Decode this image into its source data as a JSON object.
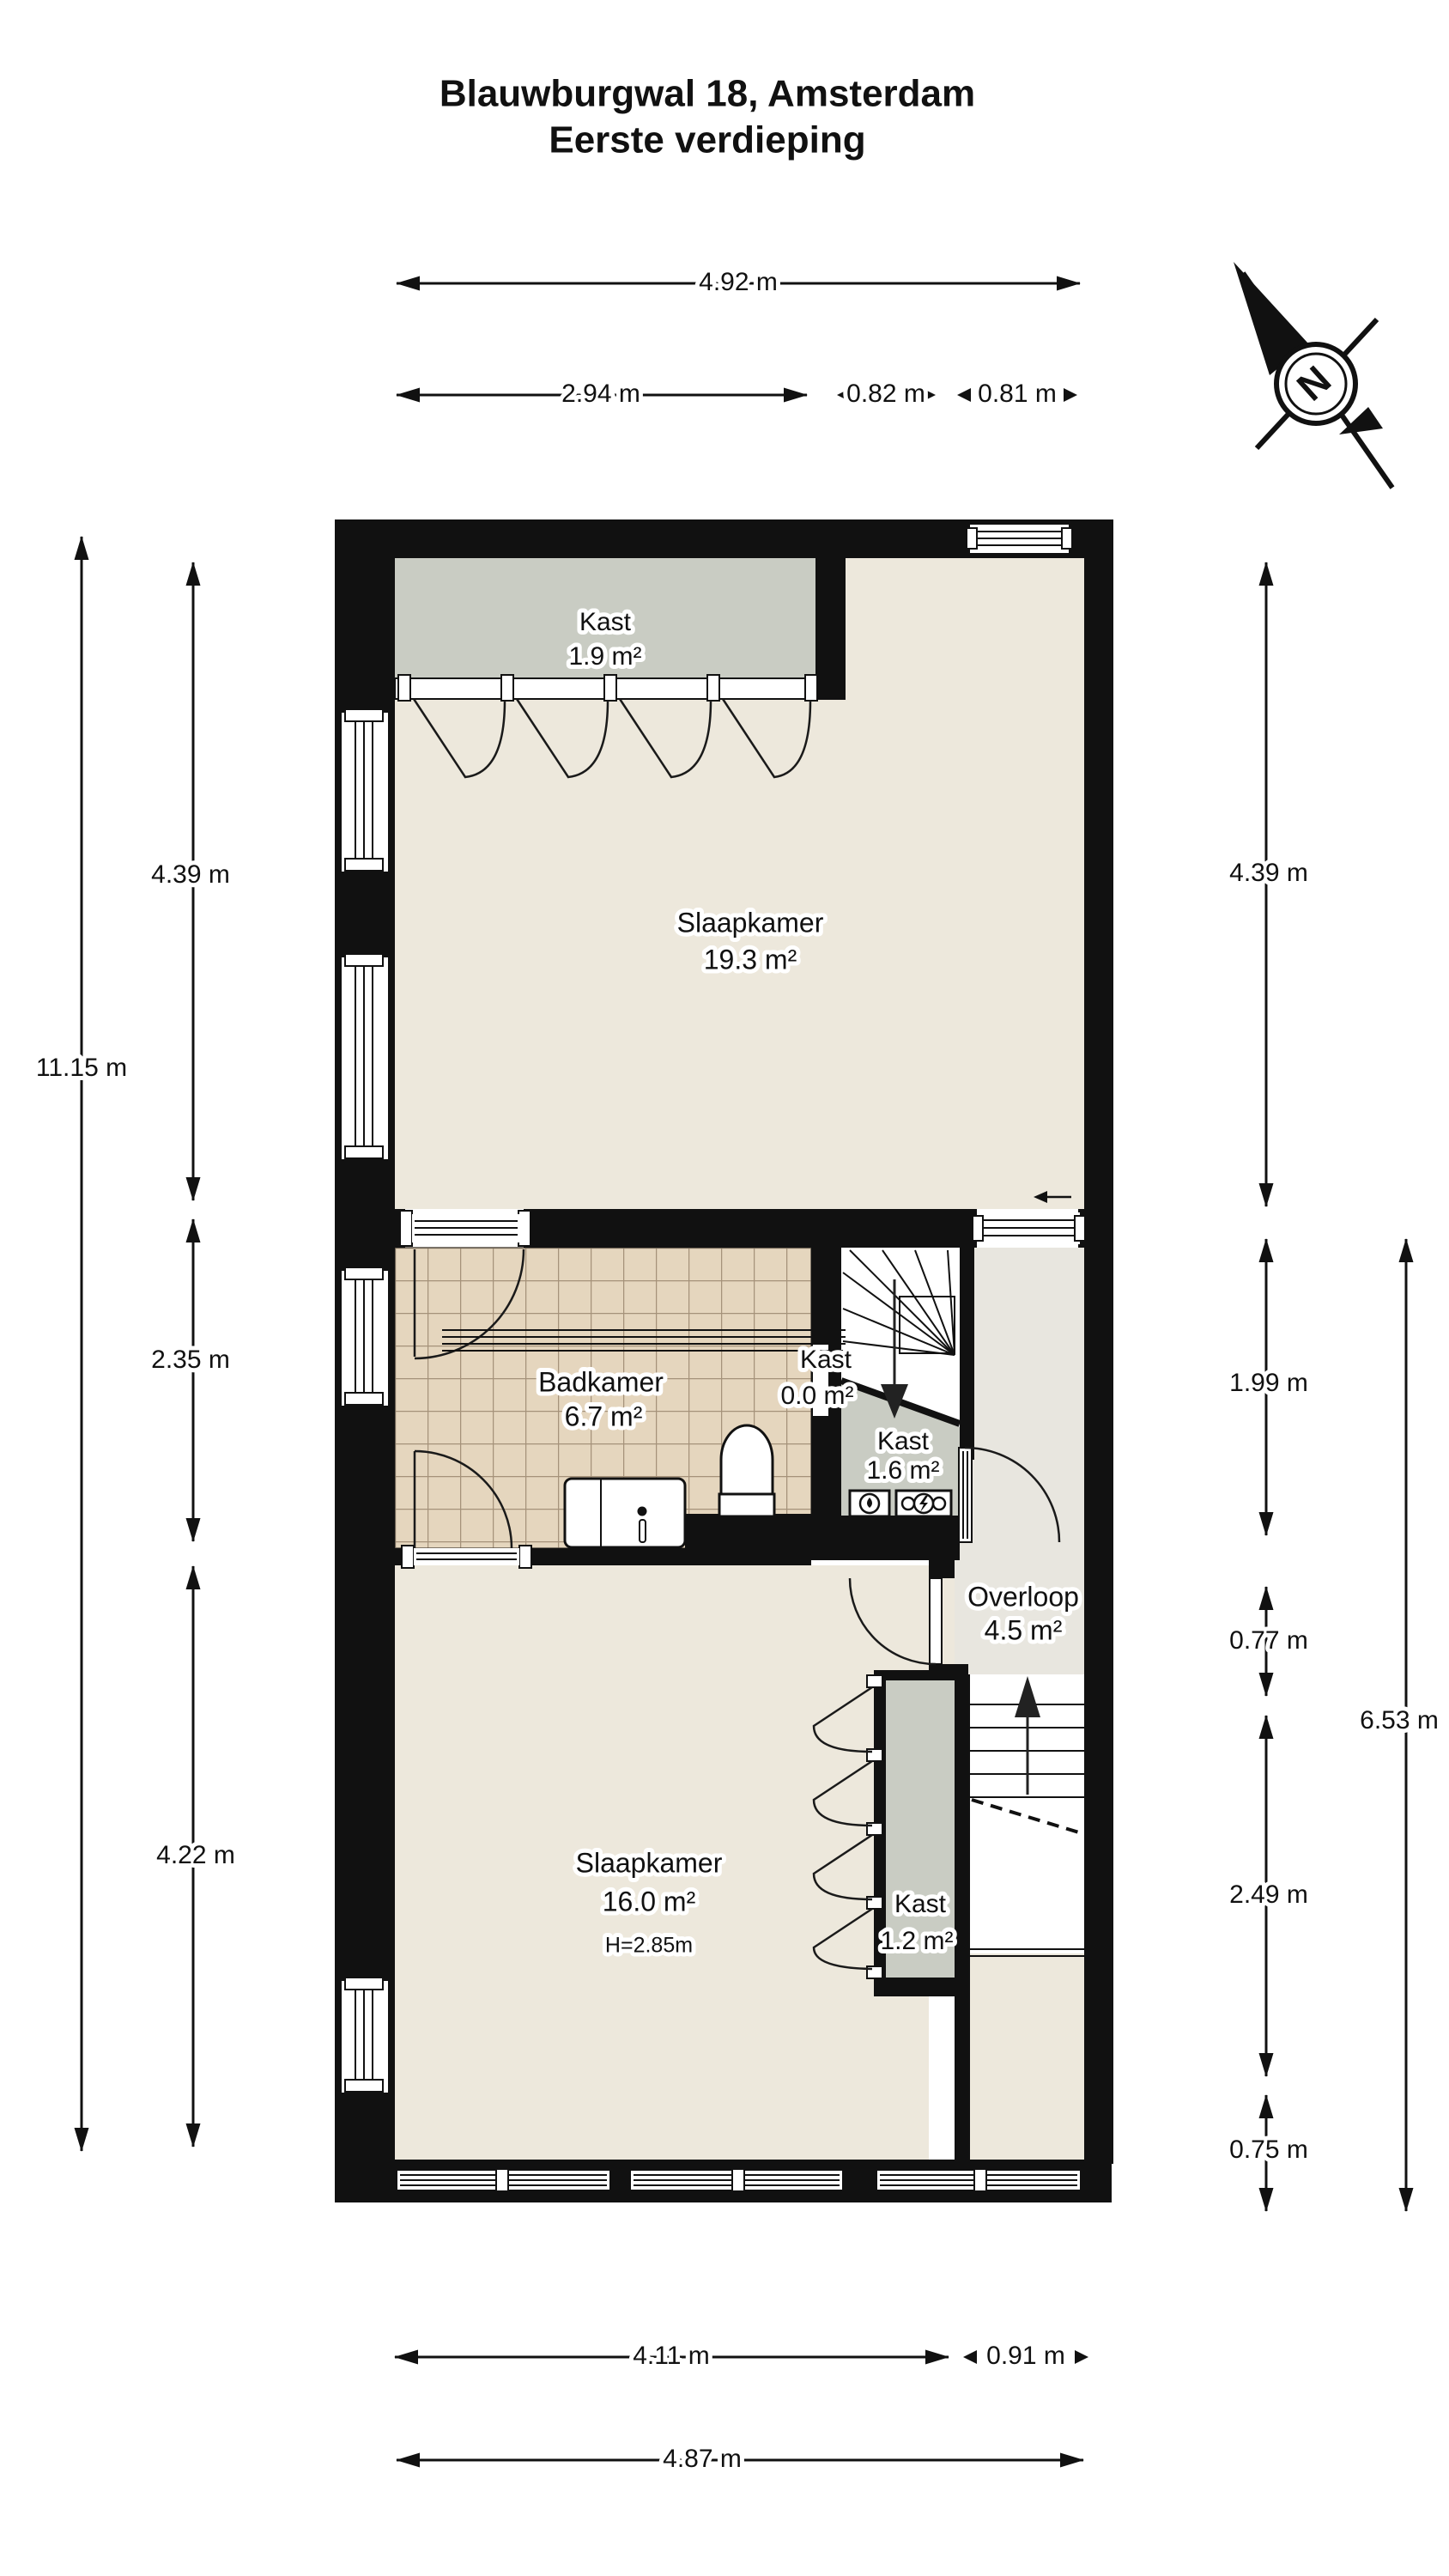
{
  "title": {
    "line1": "Blauwburgwal 18, Amsterdam",
    "line2": "Eerste verdieping"
  },
  "compass": {
    "label": "N"
  },
  "rooms": {
    "kast_top": {
      "name": "Kast",
      "area": "1.9 m²"
    },
    "slaapkamer_1": {
      "name": "Slaapkamer",
      "area": "19.3 m²"
    },
    "badkamer": {
      "name": "Badkamer",
      "area": "6.7 m²"
    },
    "kast_klein": {
      "name": "Kast",
      "area": "0.0 m²"
    },
    "kast_trap": {
      "name": "Kast",
      "area": "1.6 m²"
    },
    "overloop": {
      "name": "Overloop",
      "area": "4.5 m²"
    },
    "slaapkamer_2": {
      "name": "Slaapkamer",
      "area": "16.0 m²",
      "height_note": "H=2.85m"
    },
    "kast_slaapkamer": {
      "name": "Kast",
      "area": "1.2 m²"
    }
  },
  "dimensions": {
    "top": {
      "total": "4.92 m",
      "left": "2.94 m",
      "mid": "0.82 m",
      "right": "0.81 m"
    },
    "left": {
      "total": "11.15 m",
      "upper": "4.39 m",
      "middle": "2.35 m",
      "lower": "4.22 m"
    },
    "right": {
      "upper": "4.39 m",
      "r1": "1.99 m",
      "r2": "0.77 m",
      "r3": "2.49 m",
      "r4": "0.75 m",
      "total": "6.53 m"
    },
    "bottom": {
      "left": "4.11 m",
      "right": "0.91 m",
      "total": "4.87 m"
    }
  },
  "colors": {
    "wall": "#111111",
    "floor": "#EDE8DC",
    "tile": "#E5D6BE",
    "grout": "#A5927A",
    "closet": "#C9CCC3",
    "landing": "#E8E6DF",
    "white": "#FFFFFF"
  }
}
